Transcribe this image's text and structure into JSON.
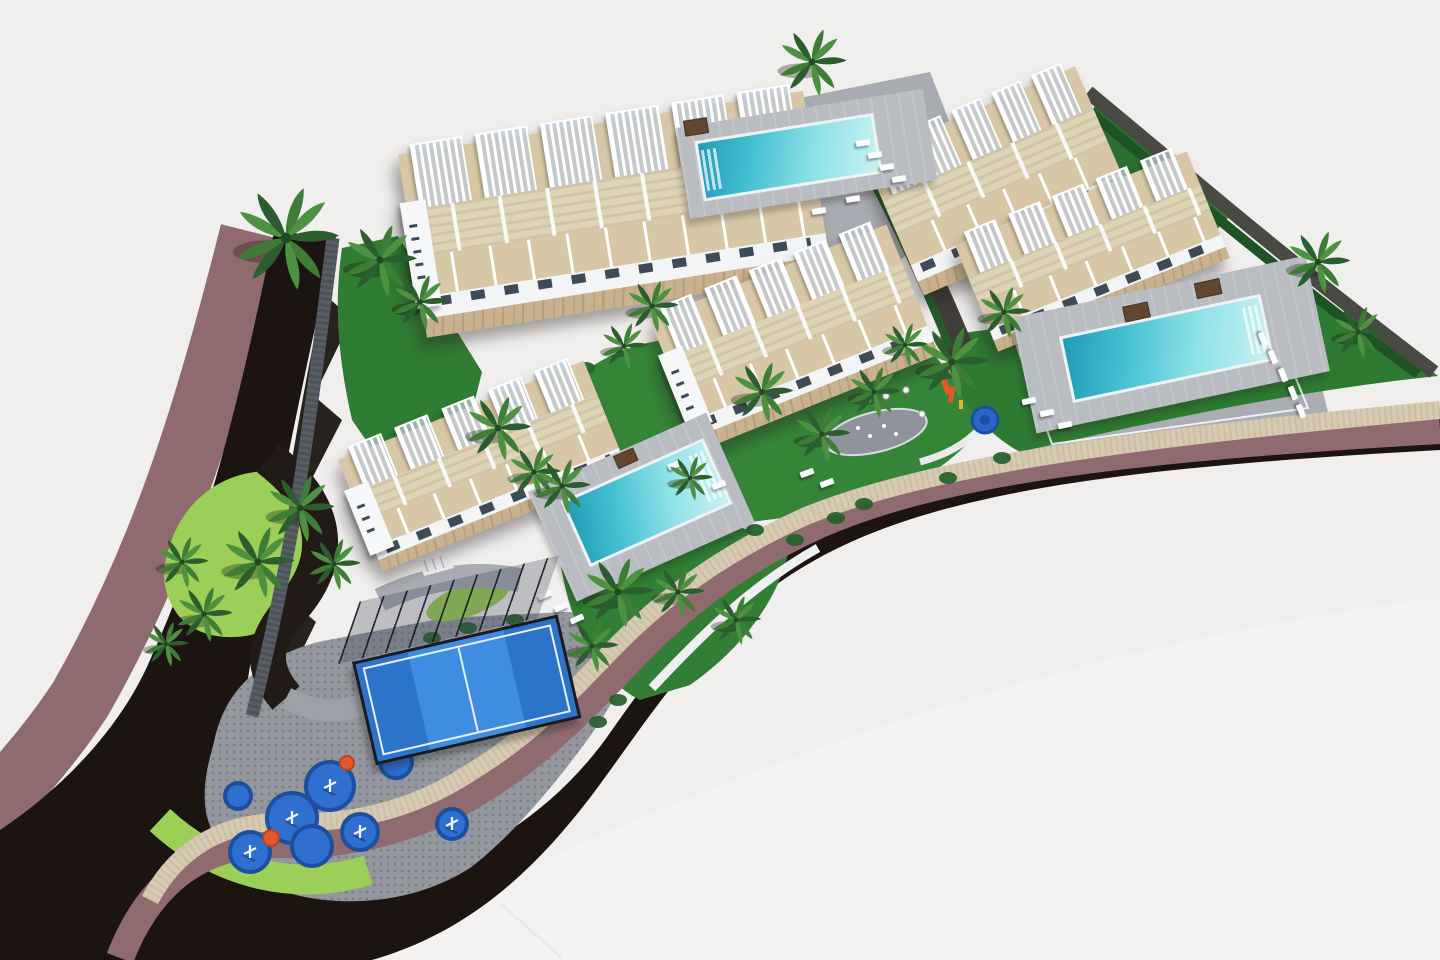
{
  "palette": {
    "background": "#f0efee",
    "background_sheen": "#f3f2f0",
    "road": "#1b1411",
    "sidewalk_mauve": "#8f6a6f",
    "perimeter_wall_beige": "#d6cab3",
    "wall_texture": "#c3b294",
    "boundary_wall_gray": "#5a5e66",
    "lime_lawn": "#9ccf57",
    "lawn_green": "#2f7c33",
    "lawn_bright": "#358538",
    "paver_gray": "#95979f",
    "paver_dot": "#7d7f88",
    "pool_deck": "#b9bcc1",
    "water_deep": "#1f9bb8",
    "water_light": "#c9f1f3",
    "terrace_tan": "#d8c7a6",
    "terrace_tan_light": "#e0d3b4",
    "facade_white": "#f3f4f6",
    "window_dark": "#3e4b57",
    "stone_base": "#c9b28f",
    "padel_blue": "#2f7fd6",
    "play_blue": "#2e6fd0",
    "play_ring": "#1d4fa0",
    "play_orange": "#e2582b",
    "palm_dark": "#2c5d2e",
    "palm_mid": "#3f7d36",
    "palm_light": "#4e9140",
    "hedge": "#1e5424"
  },
  "scene": {
    "ground": [
      {
        "t": "p",
        "name": "background-sheen",
        "d": "M 340,960 C 700,770 1080,640 1440,598 L 1440,960 Z",
        "fill": "#f3f2f0"
      },
      {
        "t": "p",
        "name": "sidewalk-outer-west",
        "d": "M 252,232 C 205,420 160,560 80,700 C 40,760 0,800 -30,830",
        "stroke": "#8f6a6f",
        "width": 64
      },
      {
        "t": "p",
        "name": "road-main",
        "d": "M 336,236 L 274,232 C 240,400 205,540 150,660 C 120,730 60,790 0,830 L 0,960 L 372,960 C 470,932 540,868 606,776 C 664,696 700,640 780,582 C 900,498 1080,470 1440,450 L 1440,418 C 1100,440 920,472 800,540 C 718,588 668,650 612,730 C 560,806 480,862 380,886 C 300,902 240,862 236,790 C 238,700 290,430 336,236 Z",
        "fill": "#1b1411"
      },
      {
        "t": "p",
        "name": "wall-shadow-jagged",
        "d": "M 336,240 L 326,296 L 352,318 L 314,396 L 342,420 L 302,498 L 330,520 L 290,600 L 316,622 L 278,700 L 300,718 L 262,788 L 252,784 C 254,700 290,430 336,240 Z",
        "fill": "#16100b",
        "opacity": 0.92
      },
      {
        "t": "p",
        "name": "paver-plaza",
        "d": "M 214,742 C 224,692 258,658 318,642 L 444,618 L 566,612 C 604,614 624,636 636,662 L 600,722 C 560,780 510,838 470,868 C 420,900 356,908 300,896 C 250,884 214,852 206,812 C 202,786 208,764 214,742 Z",
        "fill": "#95979f"
      },
      {
        "t": "p",
        "name": "paver-texture",
        "d": "M 214,742 C 224,692 258,658 318,642 L 444,618 L 566,612 C 604,614 624,636 636,662 L 600,722 C 560,780 510,838 470,868 C 420,900 356,908 300,896 C 250,884 214,852 206,812 C 202,786 208,764 214,742 Z",
        "fill": "url(#dots)"
      },
      {
        "t": "p",
        "name": "lime-lawn-corner",
        "d": "M 160,820 C 220,876 300,892 368,870",
        "stroke": "#9ccf57",
        "width": 30
      },
      {
        "t": "p",
        "name": "lime-lawn-island",
        "d": "M 170,545 C 190,480 260,455 310,482 C 345,502 340,560 310,600 C 270,645 205,648 178,615 C 160,590 162,568 170,545 Z",
        "fill": "#9ccf57"
      },
      {
        "t": "e",
        "name": "lime-strip",
        "cx": 468,
        "cy": 600,
        "rx": 44,
        "ry": 16,
        "rot": -20,
        "fill": "#9ccf57"
      },
      {
        "t": "p",
        "name": "internal-drive",
        "d": "M 268,458 C 326,502 338,556 292,608 C 262,642 260,668 286,698",
        "stroke": "#221a16",
        "width": 36
      },
      {
        "t": "p",
        "name": "path-connector",
        "d": "M 286,698 C 320,716 352,714 384,694",
        "stroke": "#9ea0a8",
        "width": 22
      },
      {
        "t": "p",
        "name": "path-entry",
        "d": "M 380,600 C 420,580 470,570 520,580",
        "stroke": "#a9abb2",
        "width": 24
      },
      {
        "t": "p",
        "name": "lawn-west",
        "d": "M 342,248 L 398,236 L 482,372 L 462,452 L 402,492 L 352,420 C 334,340 336,290 342,248 Z",
        "fill": "#2f7c33"
      },
      {
        "t": "p",
        "name": "lawn-top",
        "d": "M 640,152 L 706,136 L 722,222 L 662,240 Z",
        "fill": "#2f7c33"
      },
      {
        "t": "p",
        "name": "pool-plaza-north",
        "d": "M 690,120 L 930,72 L 980,200 L 900,260 L 760,250 L 690,180 Z",
        "fill": "#a8abb1"
      },
      {
        "t": "p",
        "name": "garden-central",
        "d": "M 560,392 C 600,352 650,336 700,338 L 918,336 L 988,418 C 962,458 912,492 850,510 L 700,528 C 650,530 612,506 592,470 Z",
        "fill": "#358538"
      },
      {
        "t": "p",
        "name": "pool-plaza-east",
        "d": "M 1000,330 L 1300,300 L 1330,420 L 1040,456 Z",
        "fill": "#aaadb3"
      },
      {
        "t": "p",
        "name": "lawn-east",
        "d": "M 940,336 L 1240,296 C 1310,290 1370,316 1428,368 L 1438,376 C 1300,390 1160,420 1020,452 C 980,430 950,390 940,336 Z",
        "fill": "#2e7a32"
      },
      {
        "t": "p",
        "name": "lawn-south",
        "d": "M 560,560 C 600,530 660,515 720,520 L 790,545 C 780,600 740,650 690,685 L 640,700 C 600,680 570,630 560,560 Z",
        "fill": "#317e34"
      },
      {
        "t": "p",
        "name": "lawn-northeast",
        "d": "M 1095,105 L 1228,218 L 1185,262 L 1072,162 Z",
        "fill": "#2c6f30"
      },
      {
        "t": "p",
        "name": "retaining-wall-center",
        "d": "M 846,112 C 890,190 928,270 962,352",
        "stroke": "#413c35",
        "width": 26
      },
      {
        "t": "p",
        "name": "hedge-center",
        "d": "M 838,118 C 880,190 918,268 950,348",
        "stroke": "#235c28",
        "width": 8
      },
      {
        "t": "p",
        "name": "boundary-wall-ne",
        "d": "M 1088,92 L 1232,212 C 1300,268 1368,322 1434,372",
        "stroke": "#4a4a44",
        "width": 14
      },
      {
        "t": "p",
        "name": "hedge-ne",
        "d": "M 1078,102 L 1222,222 C 1288,276 1354,328 1418,374",
        "stroke": "#1e5424",
        "width": 10
      },
      {
        "t": "p",
        "name": "sidewalk-inner",
        "d": "M 120,958 C 150,880 205,840 282,844 C 350,846 420,828 478,792 C 540,754 580,712 628,662 C 680,606 740,560 820,524 C 940,472 1120,448 1440,430",
        "stroke": "#8f6a6f",
        "width": 28
      },
      {
        "t": "p",
        "name": "perimeter-wall",
        "d": "M 150,900 C 175,852 220,820 290,822 C 355,824 415,808 468,774 C 528,738 566,698 612,650 C 664,596 726,552 806,516 C 930,466 1120,440 1440,410",
        "stroke": "#d6cab3",
        "width": 18
      },
      {
        "t": "p",
        "name": "perimeter-wall-texture",
        "d": "M 150,900 C 175,852 220,820 290,822 C 355,824 415,808 468,774 C 528,738 566,698 612,650 C 664,596 726,552 806,516 C 930,466 1120,440 1440,410",
        "stroke": "#c3b294",
        "width": 18,
        "dash": "2 4",
        "opacity": 0.5
      },
      {
        "t": "p",
        "name": "boundary-wall-west",
        "d": "M 333,238 C 310,420 296,540 252,716",
        "stroke": "#5a5e66",
        "width": 13
      },
      {
        "t": "p",
        "name": "boundary-wall-west-texture",
        "d": "M 333,238 C 310,420 296,540 252,716",
        "stroke": "#474b52",
        "width": 13,
        "dash": "3 3",
        "opacity": 0.7
      },
      {
        "t": "p",
        "name": "white-wall-south",
        "d": "M 652,688 C 706,630 754,584 818,548",
        "stroke": "#edeff0",
        "width": 9
      },
      {
        "t": "p",
        "name": "stairs-entry",
        "d": "M 418,560 L 448,552 L 454,568 L 424,576 Z",
        "fill": "#eceeef"
      },
      {
        "t": "p",
        "name": "stairs-steps",
        "d": "M 424,560 L 428,572 M 432,558 L 436,570 M 440,556 L 444,568",
        "stroke": "#b9bdc2",
        "width": 1.5
      },
      {
        "t": "p",
        "name": "curved-bench",
        "d": "M 920,462 C 945,455 965,445 980,428",
        "stroke": "#e9ebec",
        "width": 7
      },
      {
        "t": "e",
        "name": "splash-pad",
        "cx": 876,
        "cy": 432,
        "rx": 52,
        "ry": 20,
        "rot": -14,
        "fill": "#90939b"
      },
      {
        "t": "e",
        "name": "splash-pad-ring",
        "cx": 876,
        "cy": 432,
        "rx": 52,
        "ry": 20,
        "rot": -14,
        "fill": "none",
        "stroke": "#d8dadd",
        "width": 2
      },
      {
        "t": "p",
        "name": "pool-fence-line",
        "d": "M 1008,322 L 1262,296 L 1308,408 L 1052,444 Z",
        "fill": "none",
        "stroke": "#ffffff",
        "width": 2,
        "opacity": 0.8
      },
      {
        "t": "p",
        "name": "street-lamp",
        "d": "M 500,903 L 562,958",
        "stroke": "#e8e8e6",
        "width": 2.5
      }
    ],
    "splash_jets": [
      [
        858,
        428
      ],
      [
        870,
        436
      ],
      [
        884,
        426
      ],
      [
        896,
        434
      ]
    ],
    "plaza_tables": [
      [
        868,
        400
      ],
      [
        886,
        396
      ],
      [
        906,
        390
      ],
      [
        922,
        414
      ]
    ],
    "play_structure": {
      "orange_rects": [
        [
          941,
          381,
          6,
          15,
          -20
        ],
        [
          951,
          386,
          5,
          16,
          12
        ]
      ],
      "yellow_rect": [
        959,
        400,
        4,
        9
      ],
      "pool_circle": [
        985,
        420,
        13
      ]
    },
    "bushes": [
      [
        432,
        638
      ],
      [
        468,
        628
      ],
      [
        515,
        620
      ],
      [
        662,
        248
      ],
      [
        700,
        238
      ],
      [
        618,
        700
      ],
      [
        598,
        722
      ],
      [
        836,
        518
      ],
      [
        864,
        504
      ],
      [
        1002,
        458
      ],
      [
        948,
        478
      ],
      [
        586,
        368
      ],
      [
        545,
        398
      ],
      [
        755,
        530
      ],
      [
        795,
        540
      ],
      [
        1190,
        300
      ],
      [
        1225,
        312
      ]
    ],
    "playground": {
      "circles": [
        [
          250,
          852,
          20
        ],
        [
          292,
          818,
          25
        ],
        [
          330,
          786,
          24
        ],
        [
          312,
          846,
          20
        ],
        [
          360,
          832,
          18
        ],
        [
          396,
          762,
          16
        ],
        [
          452,
          824,
          15
        ],
        [
          238,
          796,
          13
        ]
      ],
      "orange": [
        [
          271,
          838,
          8
        ],
        [
          347,
          763,
          7
        ]
      ],
      "equipment_on": [
        0,
        1,
        2,
        4,
        6
      ]
    },
    "buildings": [
      {
        "name": "apartment-block-1",
        "x": 398,
        "y": 155,
        "w": 410,
        "h": 185,
        "rot": -9,
        "pergolas": 6,
        "tower": true
      },
      {
        "name": "apartment-block-2",
        "x": 864,
        "y": 158,
        "w": 230,
        "h": 150,
        "rot": -23.5,
        "pergolas": 5,
        "tower": false
      },
      {
        "name": "apartment-block-3",
        "x": 955,
        "y": 245,
        "w": 250,
        "h": 115,
        "rot": -22,
        "pergolas": 5,
        "tower": false
      },
      {
        "name": "apartment-block-4",
        "x": 650,
        "y": 320,
        "w": 255,
        "h": 140,
        "rot": -22,
        "pergolas": 5,
        "tower": true
      },
      {
        "name": "apartment-block-5",
        "x": 338,
        "y": 460,
        "w": 265,
        "h": 120,
        "rot": -22,
        "pergolas": 5,
        "tower": true
      }
    ],
    "pools": [
      {
        "name": "swimming-pool-north",
        "x": 676,
        "y": 128,
        "w": 250,
        "h": 92,
        "rot": -9,
        "water": {
          "dx": 16,
          "dy": 16,
          "w": 175,
          "h": 55
        },
        "steps": "left",
        "beds": [
          {
            "dx": 8,
            "dy": -6,
            "w": 22,
            "h": 14
          }
        ]
      },
      {
        "name": "swimming-pool-east",
        "x": 1012,
        "y": 318,
        "w": 300,
        "h": 118,
        "rot": -12,
        "water": {
          "dx": 42,
          "dy": 28,
          "w": 200,
          "h": 62
        },
        "steps": "right",
        "beds": [
          {
            "dx": 110,
            "dy": 12,
            "w": 24,
            "h": 14
          },
          {
            "dx": 185,
            "dy": 4,
            "w": 24,
            "h": 14
          }
        ]
      },
      {
        "name": "swimming-pool-south",
        "x": 528,
        "y": 492,
        "w": 195,
        "h": 120,
        "rot": -24,
        "water": {
          "dx": 26,
          "dy": 22,
          "w": 150,
          "h": 66
        },
        "steps": "right",
        "beds": [
          {
            "dx": 92,
            "dy": 2,
            "w": 20,
            "h": 12
          }
        ]
      }
    ],
    "loungers": [
      [
        856,
        140,
        -9
      ],
      [
        868,
        152,
        -9
      ],
      [
        880,
        164,
        -9
      ],
      [
        892,
        176,
        -9
      ],
      [
        846,
        196,
        -9
      ],
      [
        812,
        208,
        -9
      ],
      [
        1256,
        336,
        68
      ],
      [
        1266,
        354,
        68
      ],
      [
        1276,
        372,
        68
      ],
      [
        1286,
        390,
        68
      ],
      [
        1294,
        408,
        68
      ],
      [
        1022,
        398,
        -12
      ],
      [
        1040,
        410,
        -12
      ],
      [
        1058,
        422,
        -12
      ],
      [
        538,
        592,
        -24
      ],
      [
        554,
        604,
        -24
      ],
      [
        570,
        616,
        -24
      ],
      [
        668,
        462,
        -20
      ],
      [
        690,
        472,
        -20
      ],
      [
        712,
        482,
        -20
      ],
      [
        800,
        470,
        -20
      ],
      [
        820,
        480,
        -20
      ]
    ],
    "padel": {
      "name": "padel-court",
      "x": 352,
      "y": 662,
      "w": 205,
      "h": 100,
      "rot": -13,
      "fence": {
        "dx": -14,
        "dy": -54,
        "h": 56
      }
    },
    "palms": [
      [
        286,
        238,
        1.15
      ],
      [
        380,
        260,
        0.8
      ],
      [
        420,
        302,
        0.62
      ],
      [
        300,
        508,
        0.75
      ],
      [
        258,
        562,
        0.8
      ],
      [
        334,
        564,
        0.58
      ],
      [
        498,
        428,
        0.72
      ],
      [
        534,
        472,
        0.58
      ],
      [
        562,
        486,
        0.62
      ],
      [
        618,
        592,
        0.78
      ],
      [
        592,
        646,
        0.58
      ],
      [
        678,
        592,
        0.58
      ],
      [
        652,
        306,
        0.58
      ],
      [
        624,
        346,
        0.52
      ],
      [
        762,
        392,
        0.68
      ],
      [
        822,
        434,
        0.62
      ],
      [
        874,
        392,
        0.58
      ],
      [
        812,
        62,
        0.75
      ],
      [
        952,
        362,
        0.8
      ],
      [
        1004,
        312,
        0.58
      ],
      [
        1318,
        262,
        0.7
      ],
      [
        1358,
        332,
        0.58
      ],
      [
        182,
        562,
        0.58
      ],
      [
        204,
        614,
        0.62
      ],
      [
        166,
        644,
        0.5
      ],
      [
        690,
        478,
        0.5
      ],
      [
        736,
        620,
        0.55
      ],
      [
        905,
        345,
        0.5
      ]
    ]
  }
}
